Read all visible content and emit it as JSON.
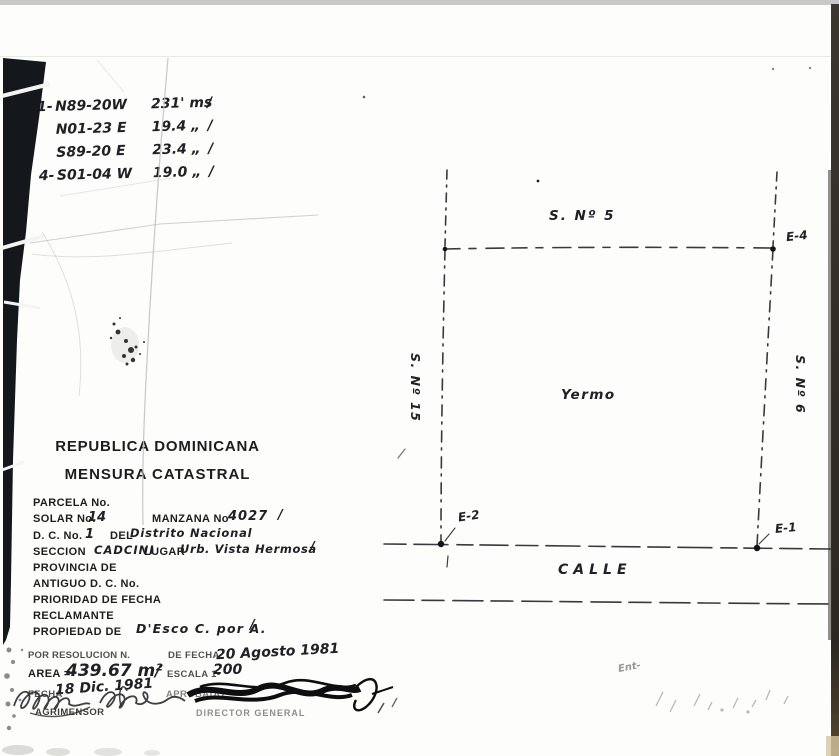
{
  "bearings": {
    "rows": [
      {
        "no": "1-",
        "bearing": "N89-20W",
        "dist": "231' ms",
        "check": "/"
      },
      {
        "no": "",
        "bearing": "N01-23 E",
        "dist": "19.4 „",
        "check": "/"
      },
      {
        "no": "",
        "bearing": "S89-20 E",
        "dist": "23.4 „",
        "check": "/"
      },
      {
        "no": "4-",
        "bearing": "S01-04 W",
        "dist": "19.0 „",
        "check": "/"
      }
    ]
  },
  "header": {
    "country": "REPUBLICA DOMINICANA",
    "doc_type": "MENSURA CATASTRAL"
  },
  "fields": {
    "parcela_label": "PARCELA No.",
    "solar_label": "SOLAR No.",
    "solar_value": "14",
    "manzana_label": "MANZANA No",
    "manzana_value": "4027",
    "manzana_check": "/",
    "dc_label": "D. C. No.",
    "dc_value": "1",
    "del_label": "DEL",
    "del_value": "Distrito Nacional",
    "seccion_label": "SECCION",
    "seccion_value": "CADCINI",
    "lugar_label": "LUGAR",
    "lugar_value": "Urb. Vista Hermosa",
    "lugar_check": "/",
    "provincia_label": "PROVINCIA DE",
    "antiguo_label": "ANTIGUO D. C. No.",
    "prioridad_label": "PRIORIDAD DE FECHA",
    "reclamante_label": "RECLAMANTE",
    "propiedad_label": "PROPIEDAD DE",
    "propiedad_value": "D'Esco C. por A.",
    "propiedad_check": "/"
  },
  "resolution": {
    "resolucion_label": "POR RESOLUCION N.",
    "defecha_label": "DE FECHA",
    "defecha_value": "20 Agosto 1981",
    "area_label": "AREA =",
    "area_value": "439.67 m²",
    "area_slash": "/",
    "escala_label": "ESCALA 1-",
    "escala_value": "200",
    "fecha_label": "FECHA",
    "fecha_value": "18 Dic. 1981",
    "aprobado_label": "APROBADO",
    "agrimensor_label": "AGRIMENSOR",
    "director_label": "DIRECTOR GENERAL"
  },
  "plan": {
    "top_label": "S. Nº 5",
    "left_label": "S. Nº 15",
    "right_label": "S. Nº 6",
    "center_label": "Yermo",
    "street_label": "CALLE",
    "corner_e1": "E-1",
    "corner_e2": "E-2",
    "corner_e4": "E-4",
    "note": "Ent-"
  }
}
